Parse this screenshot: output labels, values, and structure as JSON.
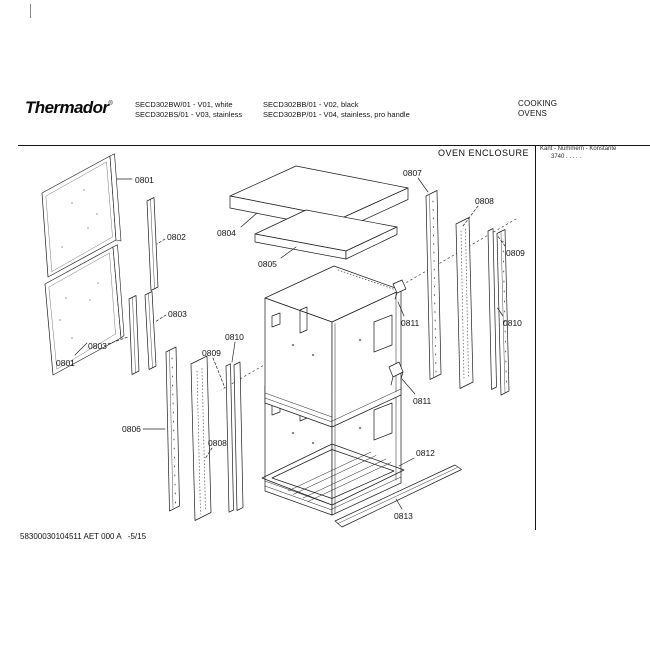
{
  "window": {
    "width": 650,
    "height": 650,
    "background": "#ffffff",
    "ink": "#1c1c1c"
  },
  "header": {
    "brand": "Thermador",
    "brand_mark": "®",
    "models": [
      "SECD302BW/01 - V01, white",
      "SECD302BS/01 - V03, stainless",
      "SECD302BB/01 - V02, black",
      "SECD302BP/01 - V04, stainless, pro handle"
    ],
    "category": [
      "COOKING",
      "OVENS"
    ]
  },
  "drawing": {
    "title": "OVEN ENCLOSURE",
    "ref_note": [
      "Kant - Nummern - Konstante",
      "3740 . .  . . ."
    ],
    "doc_number": "58300030104511 AET 000 A   -5/15",
    "callouts": [
      {
        "label": "0801"
      },
      {
        "label": "0802"
      },
      {
        "label": "0803"
      },
      {
        "label": "0803"
      },
      {
        "label": "0801"
      },
      {
        "label": "0804"
      },
      {
        "label": "0805"
      },
      {
        "label": "0807"
      },
      {
        "label": "0808"
      },
      {
        "label": "0809"
      },
      {
        "label": "0810"
      },
      {
        "label": "0811"
      },
      {
        "label": "0811"
      },
      {
        "label": "0806"
      },
      {
        "label": "0809"
      },
      {
        "label": "0810"
      },
      {
        "label": "0808"
      },
      {
        "label": "0812"
      },
      {
        "label": "0813"
      }
    ]
  }
}
